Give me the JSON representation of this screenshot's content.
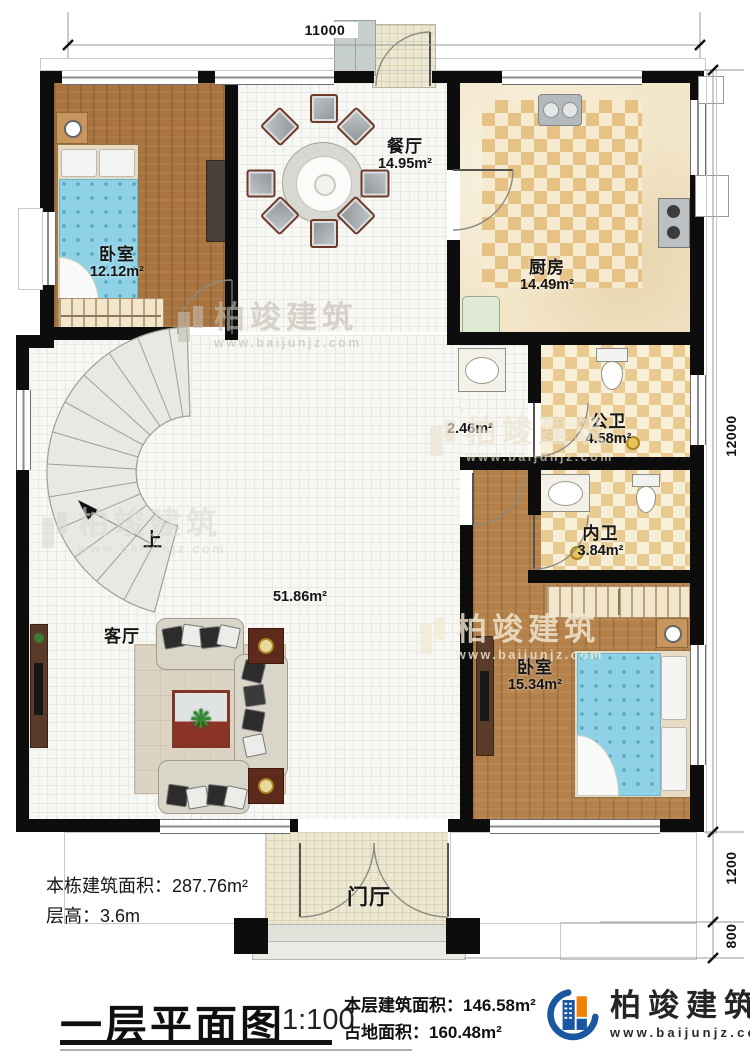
{
  "dims": {
    "top": "11000",
    "right_main": "12000",
    "right_porch": "1200",
    "right_steps": "800"
  },
  "rooms": {
    "bedroom1": {
      "name": "卧室",
      "area": "12.12m²"
    },
    "dining": {
      "name": "餐厅",
      "area": "14.95m²"
    },
    "kitchen": {
      "name": "厨房",
      "area": "14.49m²"
    },
    "public_bath": {
      "name": "公卫",
      "area": "4.58m²"
    },
    "inner_bath": {
      "name": "内卫",
      "area": "3.84m²"
    },
    "bedroom2": {
      "name": "卧室",
      "area": "15.34m²"
    },
    "living": {
      "name": "客厅",
      "area": "51.86m²"
    },
    "foyer": {
      "name": "门厅"
    },
    "corridor_area": "2.46m²",
    "stairs_up": "上"
  },
  "notes": {
    "building_area": "本栋建筑面积：287.76m²",
    "floor_height": "层高：3.6m"
  },
  "footer": {
    "title": "一层平面图",
    "scale": "1:100",
    "floor_area": "本层建筑面积：146.58m²",
    "footprint": "占地面积：160.48m²"
  },
  "brand": {
    "name": "柏竣建筑",
    "url": "www.baijunjz.com"
  },
  "watermark": {
    "name": "柏竣建筑",
    "url": "www.baijunjz.com"
  },
  "colors": {
    "brand_blue": "#1a57a0",
    "brand_orange": "#ef8200",
    "wall": "#0d0d0d"
  }
}
